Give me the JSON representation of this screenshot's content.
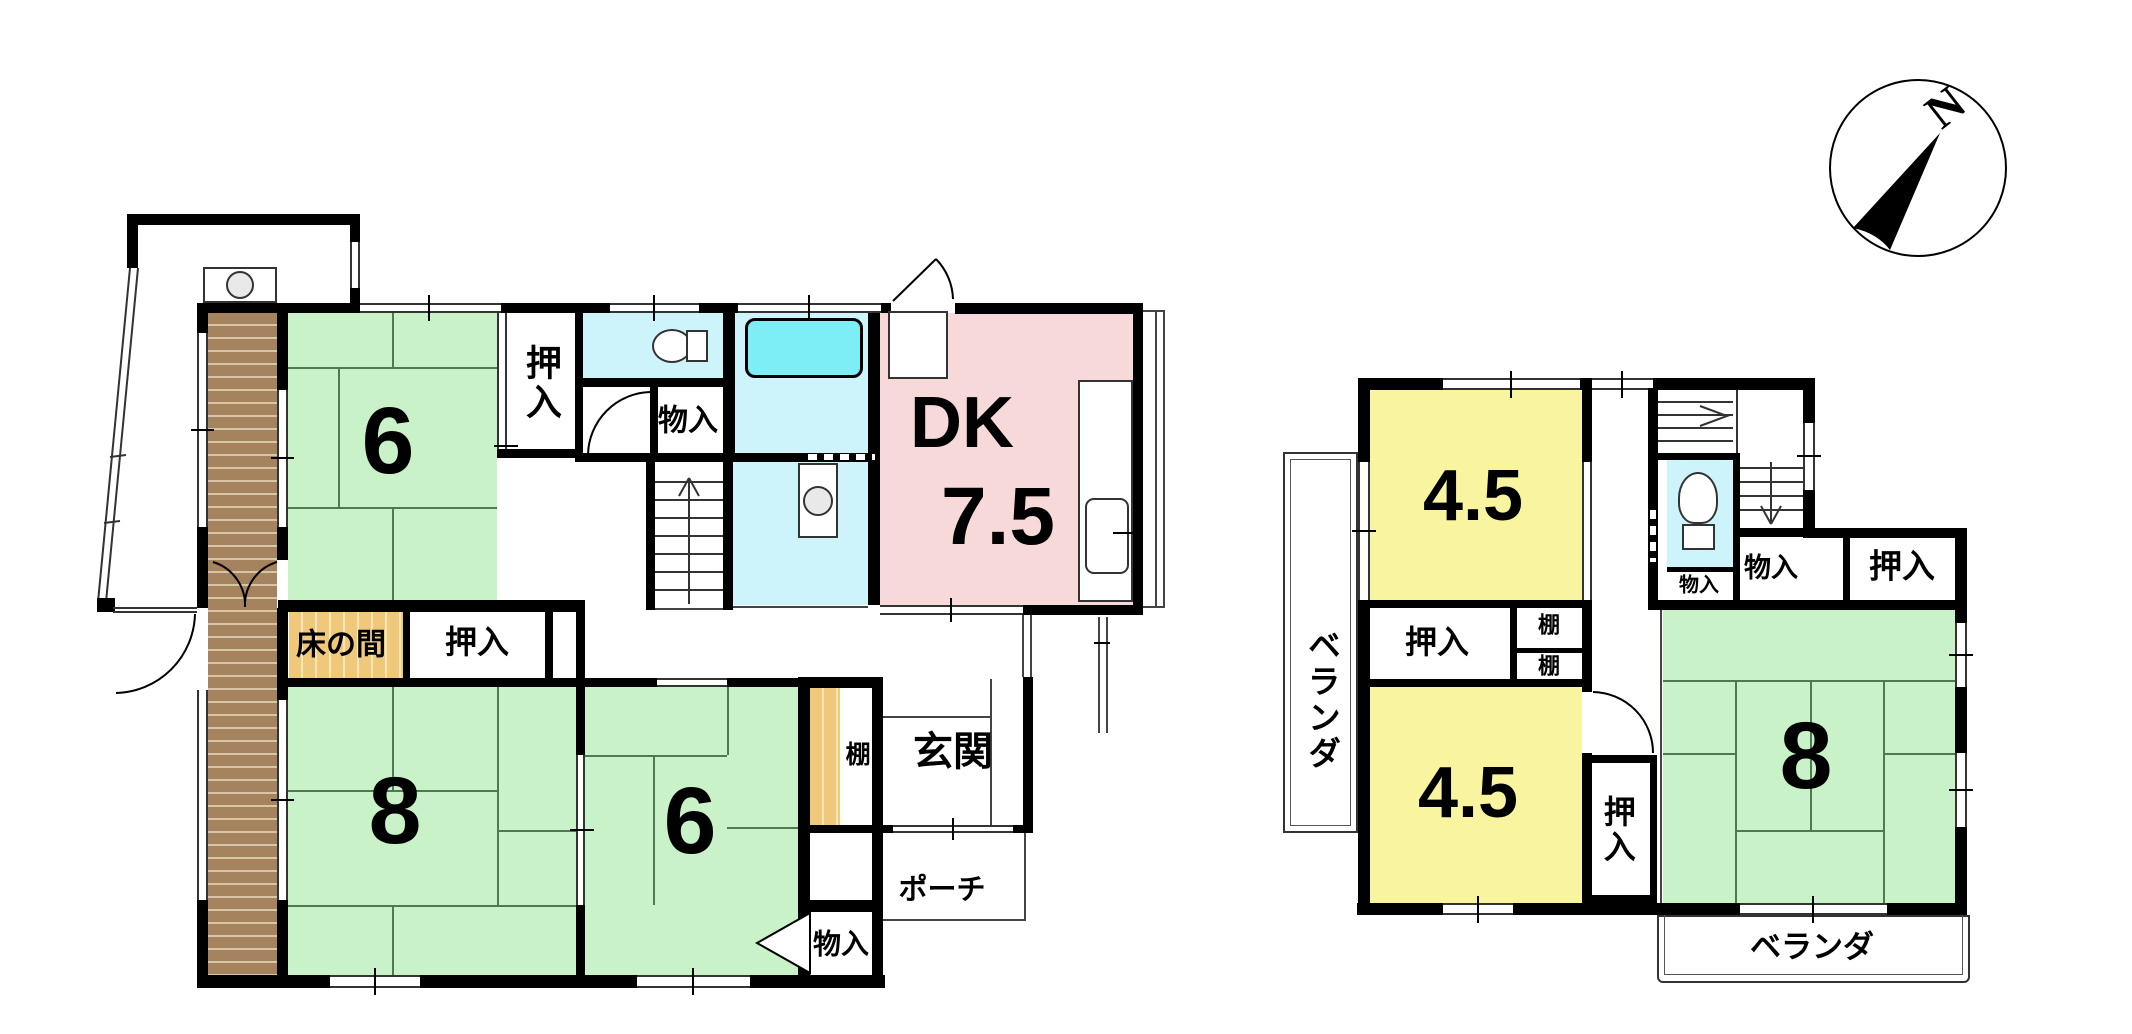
{
  "compass": {
    "north": "N"
  },
  "colors": {
    "tatami_green": "#c9f2c9",
    "room_yellow": "#f8f4a0",
    "dk_pink": "#f8d9d9",
    "wet_cyan": "#cdf4fa",
    "tub_cyan": "#7deef5",
    "wood_tan": "#efc87c",
    "engawa_brown": "#a5835f",
    "wall_black": "#000000"
  },
  "floor1": {
    "tatami6_north": "6",
    "tatami8": "8",
    "tatami6_south": "6",
    "dk": "DK",
    "dk_size": "7.5",
    "oshiire_north": "押入",
    "oshiire_center": "押入",
    "monoire_hall": "物入",
    "monoire_entry": "物入",
    "tokonoma": "床の間",
    "tana": "棚",
    "genkan": "玄関",
    "porch": "ポーチ"
  },
  "floor2": {
    "room45_north": "4.5",
    "room45_south": "4.5",
    "tatami8": "8",
    "oshiire_west": "押入",
    "oshiire_east": "押入",
    "oshiire_south": "押入",
    "tana_upper": "棚",
    "tana_lower": "棚",
    "monoire_small": "物入",
    "monoire": "物入",
    "veranda_west": "ベランダ",
    "veranda_south": "ベランダ"
  }
}
